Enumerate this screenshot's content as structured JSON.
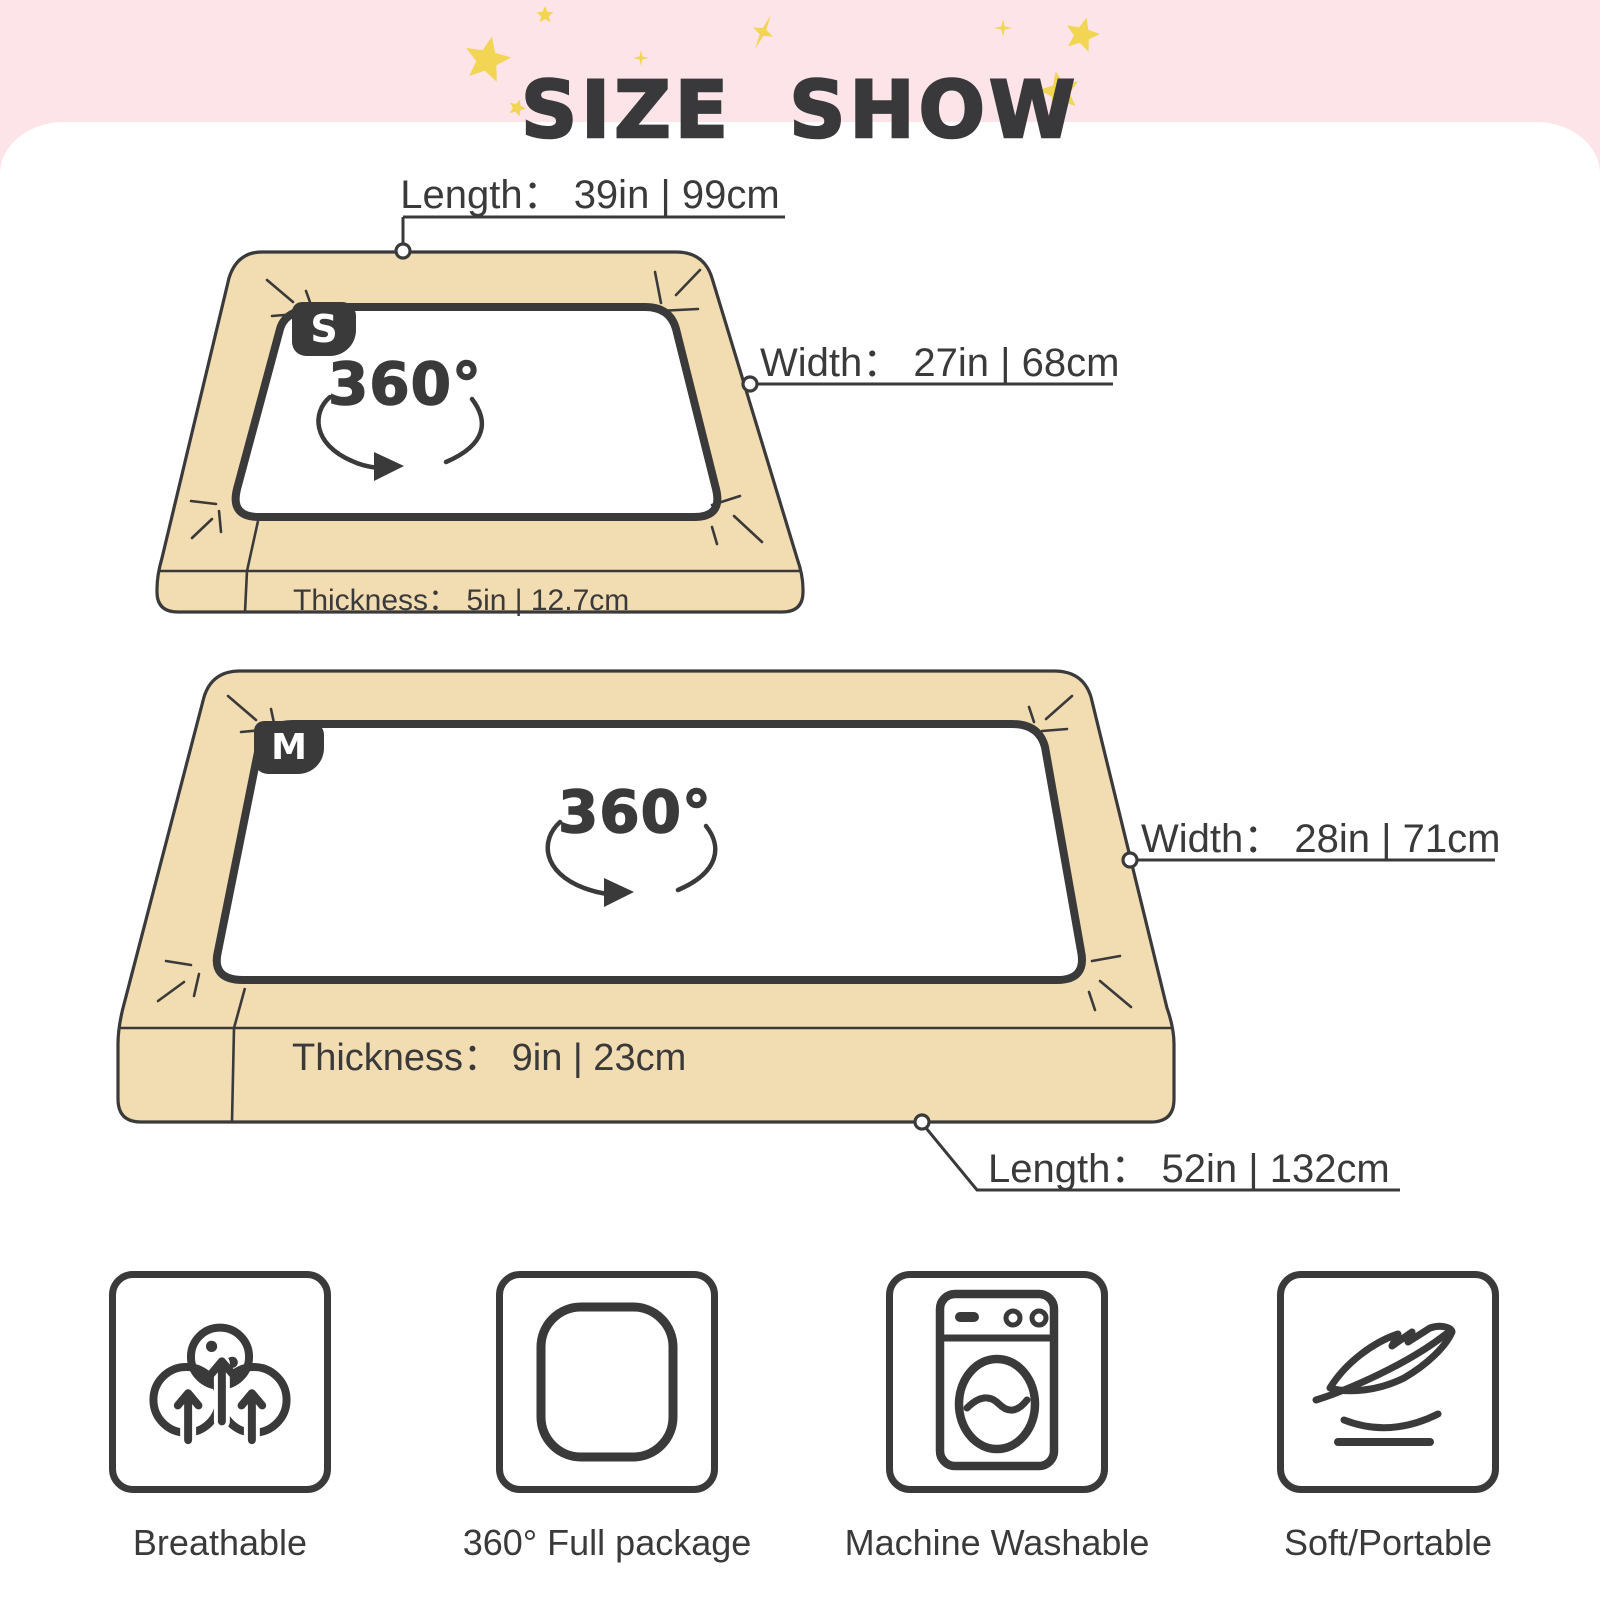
{
  "header": {
    "title": "SIZE SHOW"
  },
  "size_s": {
    "badge": "S",
    "rotation": "360°",
    "length": "Length： 39in | 99cm",
    "width": "Width： 27in | 68cm",
    "thickness": "Thickness： 5in | 12.7cm"
  },
  "size_m": {
    "badge": "M",
    "rotation": "360°",
    "width": "Width： 28in | 71cm",
    "thickness": "Thickness： 9in | 23cm",
    "length": "Length： 52in | 132cm"
  },
  "features": [
    {
      "icon": "breathable-icon",
      "label": "Breathable"
    },
    {
      "icon": "full-package-icon",
      "label": "360° Full package"
    },
    {
      "icon": "machine-washable-icon",
      "label": "Machine Washable"
    },
    {
      "icon": "feather-icon",
      "label": "Soft/Portable"
    }
  ],
  "colors": {
    "banner_pink": "#FCE4E9",
    "star_yellow": "#F2D552",
    "bed_tan": "#F2DCB2",
    "ink": "#3A3A3A"
  }
}
